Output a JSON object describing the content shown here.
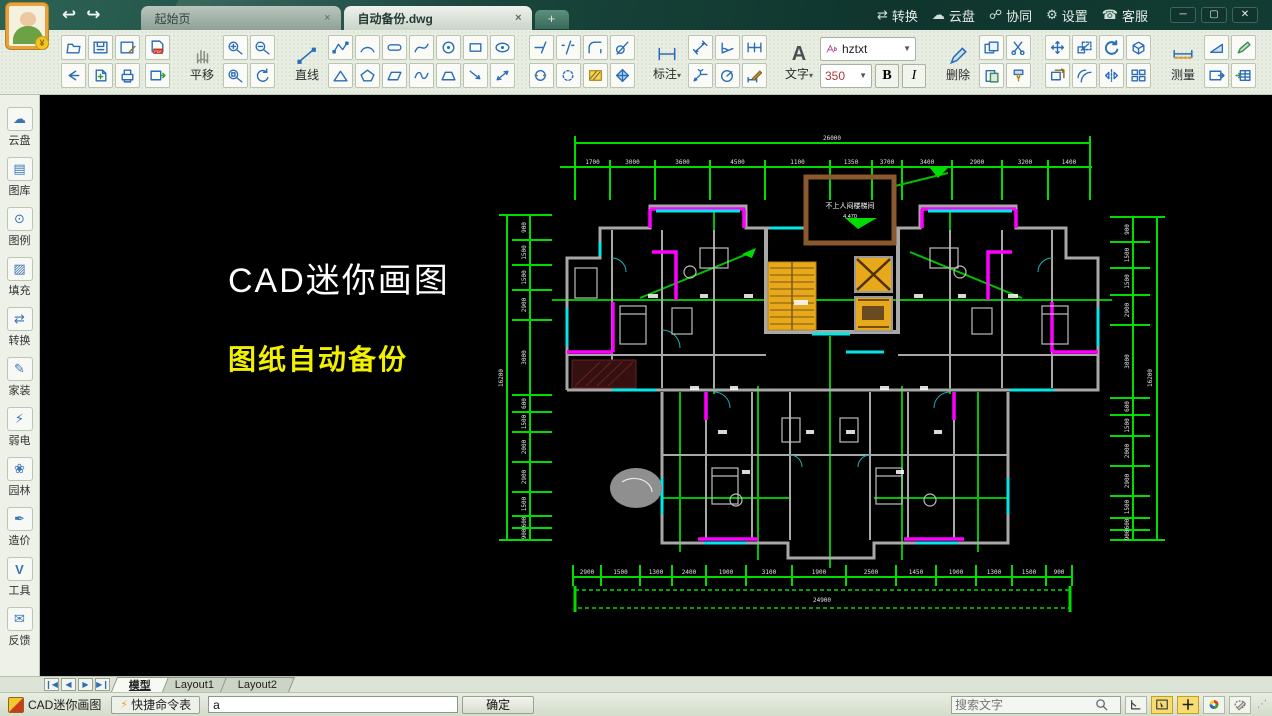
{
  "titlebar": {
    "tabs": [
      {
        "label": "起始页",
        "close": "×"
      },
      {
        "label": "自动备份.dwg",
        "close": "×"
      }
    ],
    "new_tab": "+",
    "menu": [
      "转换",
      "云盘",
      "协同",
      "设置",
      "客服"
    ],
    "window": {
      "minimize": "─",
      "maximize": "▢",
      "close": "✕"
    }
  },
  "toolbar": {
    "labels": {
      "pan": "平移",
      "line": "直线",
      "dim": "标注",
      "text": "文字",
      "delete": "删除",
      "measure": "测量",
      "layer": "图层",
      "color": "颜色"
    },
    "font_name": "hztxt",
    "font_size": "350",
    "bold": "B",
    "italic": "I",
    "pdf": "PDF",
    "swatch_colors": [
      "#ffffff",
      "#e84612",
      "#f2ef10",
      "#8cc828",
      "#000000",
      "#1890e0",
      "#10a83e",
      "#8732c8"
    ]
  },
  "sidebar": {
    "items": [
      {
        "label": "云盘"
      },
      {
        "label": "图库"
      },
      {
        "label": "图例"
      },
      {
        "label": "填充"
      },
      {
        "label": "转换"
      },
      {
        "label": "家装"
      },
      {
        "label": "弱电"
      },
      {
        "label": "园林"
      },
      {
        "label": "造价"
      },
      {
        "label": "工具"
      },
      {
        "label": "反馈"
      }
    ]
  },
  "canvas": {
    "title": "CAD迷你画图",
    "subtitle": "图纸自动备份",
    "stair_label": "不上人闷楼梯间",
    "stair_elev": "4.470"
  },
  "drawing": {
    "dims": {
      "top": [
        "1700",
        "3000",
        "3600",
        "4500",
        "1100",
        "1350",
        "3700",
        "3400",
        "2900",
        "3200",
        "1400"
      ],
      "top_total": "26000",
      "bottom": [
        "2900",
        "1500",
        "1300",
        "2400",
        "1900",
        "3100",
        "1900",
        "2500",
        "1450",
        "1900",
        "1300",
        "1500",
        "900"
      ],
      "bottom_total": "24900",
      "left": [
        "900",
        "1500",
        "1500",
        "2900",
        "3000",
        "600",
        "1500",
        "2000",
        "2900",
        "1500",
        "600",
        "900"
      ],
      "left_total": "16200",
      "right": [
        "900",
        "1500",
        "1500",
        "2900",
        "3000",
        "600",
        "1500",
        "2000",
        "2900",
        "1500",
        "600",
        "900"
      ],
      "right_total": "16200"
    },
    "colors": {
      "dimension_green": "#00dc00",
      "axis_green": "#00b400",
      "wall_gray": "#a8a8a8",
      "window_cyan": "#00e8e8",
      "highlight_magenta": "#ff00ff",
      "elevator_orange": "#e8a81c",
      "shaft_brown": "#8a5a2e"
    }
  },
  "bottombar": {
    "tabs": [
      {
        "label": "模型",
        "active": true
      },
      {
        "label": "Layout1",
        "active": false
      },
      {
        "label": "Layout2",
        "active": false
      }
    ]
  },
  "statusbar": {
    "app": "CAD迷你画图",
    "shortcut": "快捷命令表",
    "command_value": "a",
    "ok": "确定",
    "search_placeholder": "搜索文字"
  }
}
